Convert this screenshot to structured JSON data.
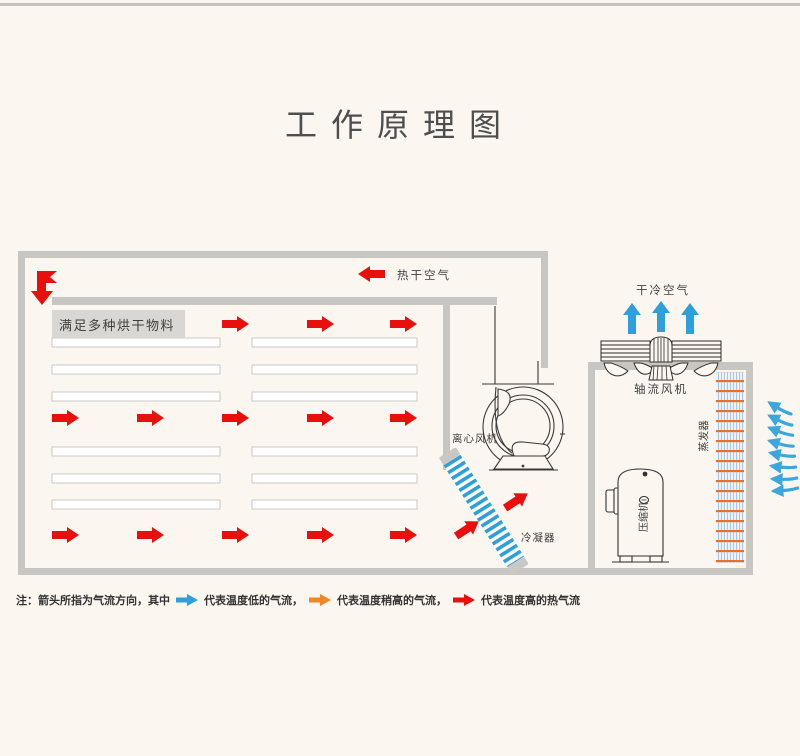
{
  "page": {
    "title": "工作原理图"
  },
  "colors": {
    "background": "#fbf6ef",
    "wall_gray": "#c7c6c3",
    "hot_airflow_red": "#e8100d",
    "cold_airflow_blue": "#2e9fd8",
    "warm_airflow_orange": "#ef8729",
    "evaporator_coil_orange": "#e4722e",
    "condenser_stripe_blue": "#2f9fd7"
  },
  "diagram": {
    "labels": {
      "hot_dry_air": "热干空气",
      "dry_cold_air": "干冷空气",
      "materials_shelf": "满足多种烘干物料",
      "axial_fan": "轴流风机",
      "centrifugal_fan": "离心风机",
      "condenser": "冷凝器",
      "compressor": "压缩机",
      "evaporator": "蒸发器"
    }
  },
  "legend": {
    "prefix": "注：箭头所指为气流方向，其中",
    "items": [
      {
        "label": "代表温度低的气流，",
        "color": "#2e9fd8"
      },
      {
        "label": "代表温度稍高的气流，",
        "color": "#ef8729"
      },
      {
        "label": "代表温度高的热气流",
        "color": "#e8100d"
      }
    ]
  }
}
